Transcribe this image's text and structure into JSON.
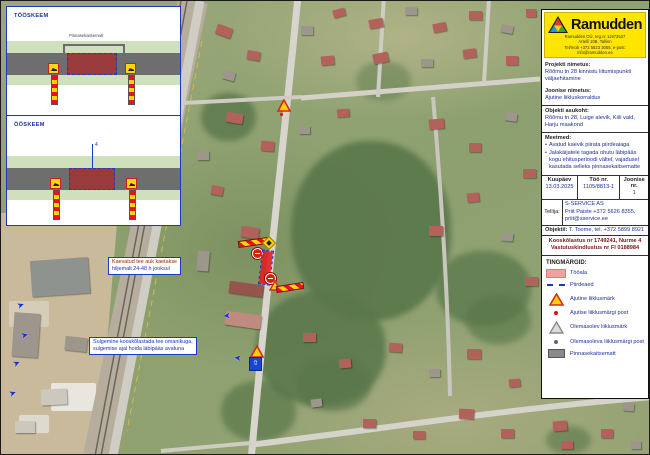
{
  "inset": {
    "diagrams": [
      {
        "title": "TÖÖSKEEM",
        "note": "Pinnasekaitsematt"
      },
      {
        "title": "ÖÖSKEEM",
        "dim": "4"
      }
    ]
  },
  "map": {
    "note1": {
      "line1": "Kaevatud tee auk kaetakse",
      "line2": "hiljemalt 24-48 h jooksul"
    },
    "note2": {
      "line1": "Sulgemine kooskõlastada tee omanikuga,",
      "line2": "sulgemise ajal hoida läbipääs avatuna"
    }
  },
  "panel": {
    "brand": "Ramudden",
    "company_lines": [
      "Ramudden OÜ, reg.nr 11973537",
      "Artelli 10B, Tallinn",
      "Tel/mob +372 5623 3055, e-post: info@ramudden.ee"
    ],
    "project_label": "Projekti nimetus:",
    "project_name": "Rõõmu tn 28 kinnistu liitumispunkti väljaehitamine",
    "drawing_label": "Joonise nimetus:",
    "drawing_name": "Ajutine liikluskorraldus",
    "location_label": "Objekti asukoht:",
    "location": "Rõõmu tn 28, Luige alevik, Kiili vald, Harju maakond",
    "measures_label": "Meetmed:",
    "measures": [
      "Avatud kaevik piirata piirdeaiaga",
      "Jalakäijatele tagada ohutu läbipääs kogu ehitusperioodi vältel, vajadusel kasutada selleks pinnasekaitsematte"
    ],
    "table": {
      "date_label": "Kuupäev",
      "date": "13.03.2025",
      "work_label": "Töö nr.",
      "work": "1105/8813-1",
      "sheet_label": "Joonise nr.",
      "sheet": "1"
    },
    "client_label": "Tellija:",
    "client_lines": [
      "S-SERVICE AS",
      "Priit Paiste +372 5626 8355,",
      "priit@sservice.ee"
    ],
    "site_label": "Objektil:",
    "site_contact": "T. Toome, tel. +372 5899 8921",
    "approval_lines": [
      "Kooskõlastus nr 1749241, Nurme 4",
      "Vastutuskindlustus nr FI 0188984"
    ],
    "legend_title": "TINGMÄRGID:",
    "legend": [
      {
        "icon": "work-area-fill",
        "label": "Tööala"
      },
      {
        "icon": "fence-dashed-line",
        "label": "Piirdeaed"
      },
      {
        "icon": "temporary-sign-triangle",
        "label": "Ajutine liiklusmärk"
      },
      {
        "icon": "temporary-sign-post-dot",
        "label": "Ajutise liiklusmärgi post"
      },
      {
        "icon": "existing-sign-triangle",
        "label": "Olemasolev liiklusmärk"
      },
      {
        "icon": "existing-sign-post-dot",
        "label": "Olemasoleva liiklusmärgi post"
      },
      {
        "icon": "ground-protection-mat",
        "label": "Pinnasekaitsematt"
      }
    ]
  },
  "colors": {
    "accent_yellow": "#ffe500",
    "work_area_red": "#e41a1c",
    "legend_pink": "#f4a0a0",
    "plan_blue": "#2038c8",
    "text_navy": "#1c2e9c"
  }
}
